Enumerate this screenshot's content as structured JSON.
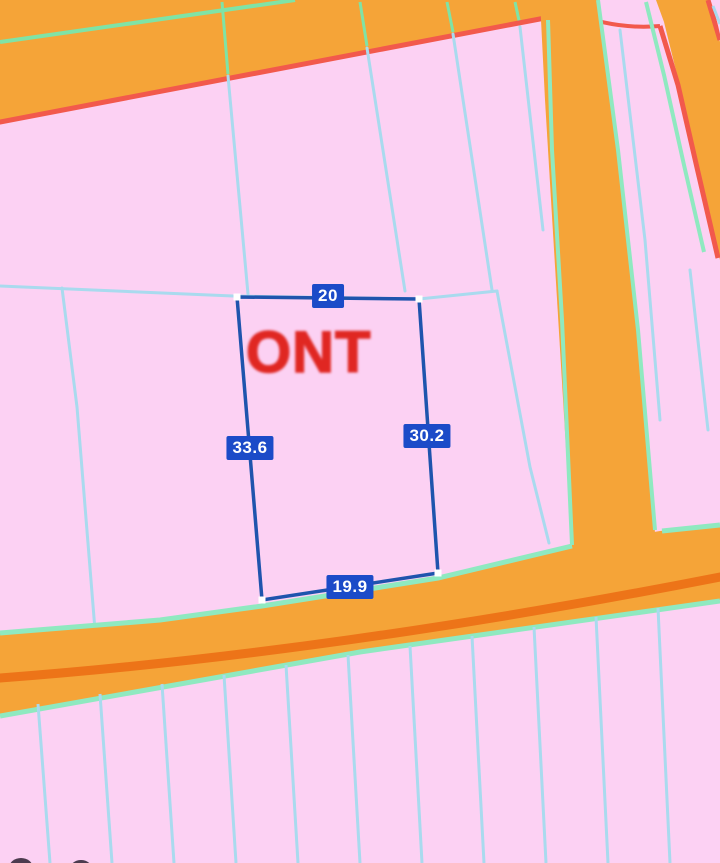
{
  "map": {
    "type": "cadastral-parcel-map",
    "watermark": "ONT",
    "selected_parcel": {
      "dimensions": {
        "top": "20",
        "left": "33.6",
        "right": "30.2",
        "bottom": "19.9"
      }
    },
    "colors": {
      "parcel_fill": "#fcd1f3",
      "road_fill": "#f5a438",
      "road_centerline": "#ed7418",
      "road_edge_red": "#f2594c",
      "road_edge_green": "#8fe9c0",
      "road_edge_green_top": "#7fe3a6",
      "parcel_boundary_line": "#a9daee",
      "selected_outline": "#1f54ad",
      "dimension_badge_bg": "#1b4bc8",
      "dimension_badge_text": "#ffffff",
      "watermark_red": "#e02722"
    }
  }
}
